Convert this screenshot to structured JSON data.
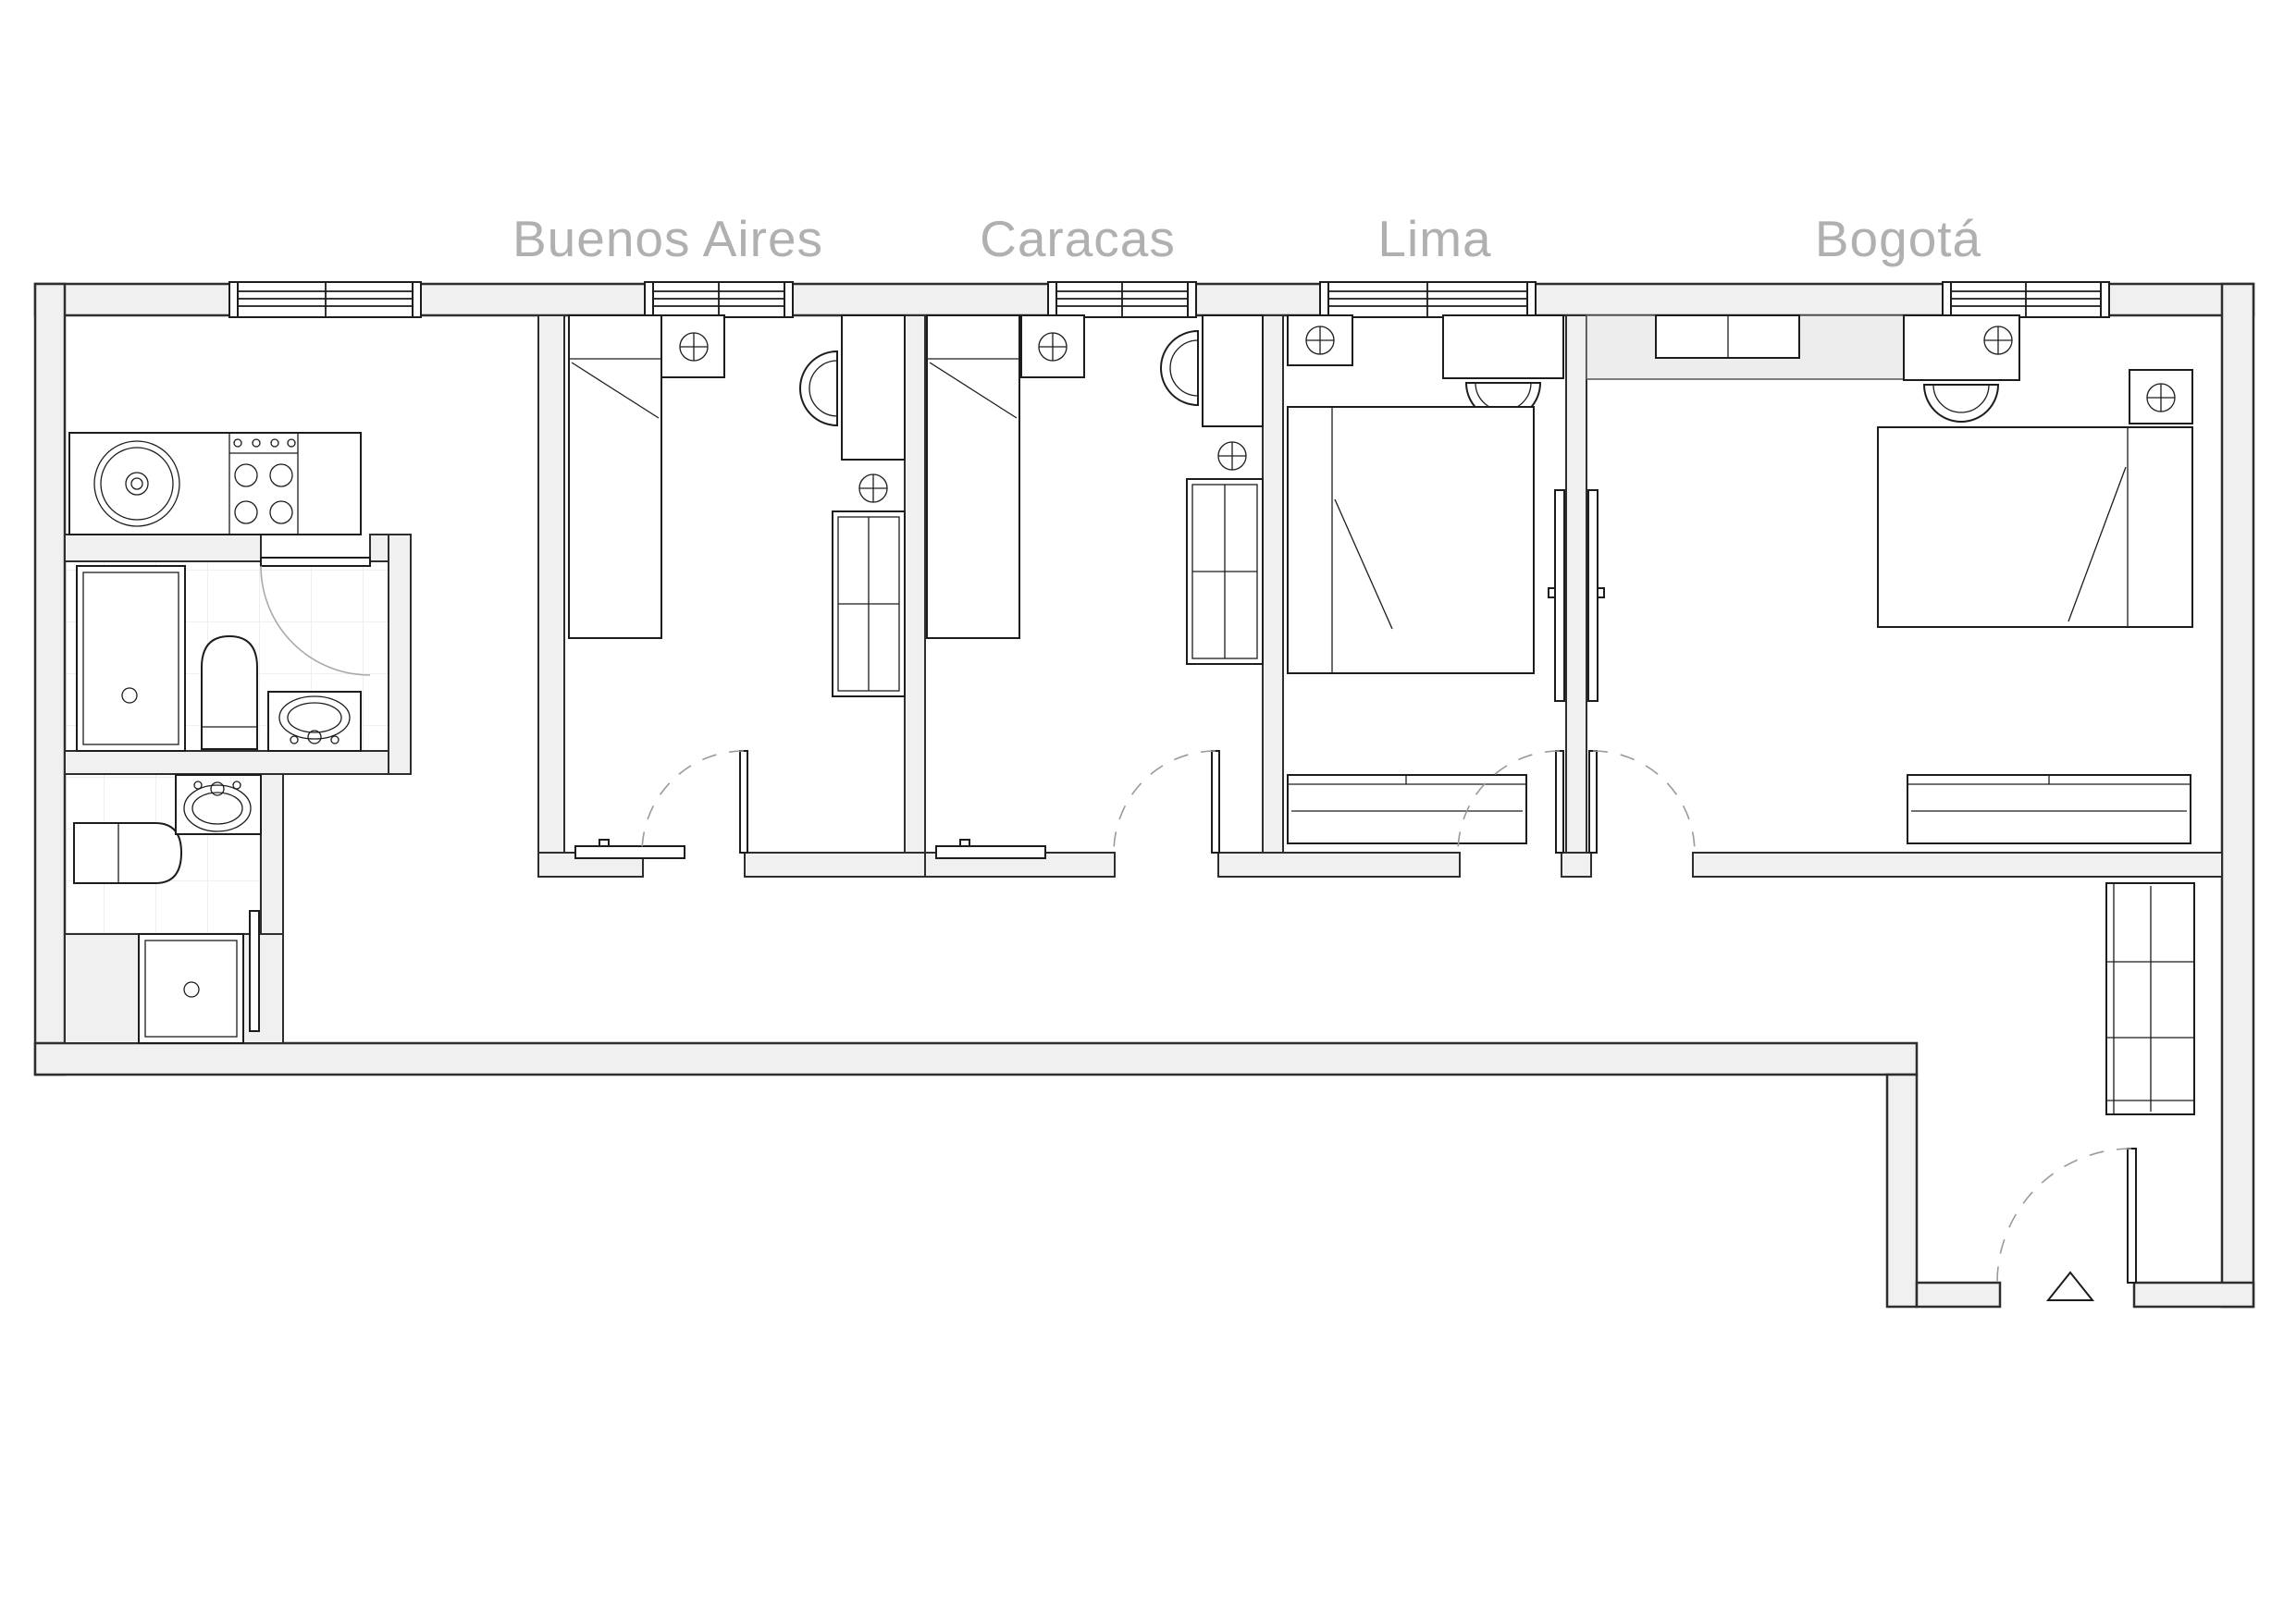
{
  "title": "apartment-floor-plan",
  "rooms": [
    {
      "name": "Buenos Aires",
      "type": "bedroom-single"
    },
    {
      "name": "Caracas",
      "type": "bedroom-single"
    },
    {
      "name": "Lima",
      "type": "bedroom-double"
    },
    {
      "name": "Bogotá",
      "type": "bedroom-single"
    }
  ],
  "unlabeled_areas": [
    "kitchen-living",
    "bathroom-1",
    "bathroom-2",
    "corridor",
    "entrance-hall"
  ],
  "colors": {
    "wall_fill": "#f0f0f0",
    "outline": "#2e2e2e",
    "furniture_line": "#1c1c1c",
    "label_gray": "#b0b0b0",
    "swing_arc": "#9a9a9a",
    "tile_line": "#efefef"
  },
  "symbols": {
    "light_socket": "circle-with-cross",
    "entrance_marker": "triangle-icon",
    "window_count": 5,
    "swing_door_count": 6,
    "sliding_door_count": 1
  }
}
